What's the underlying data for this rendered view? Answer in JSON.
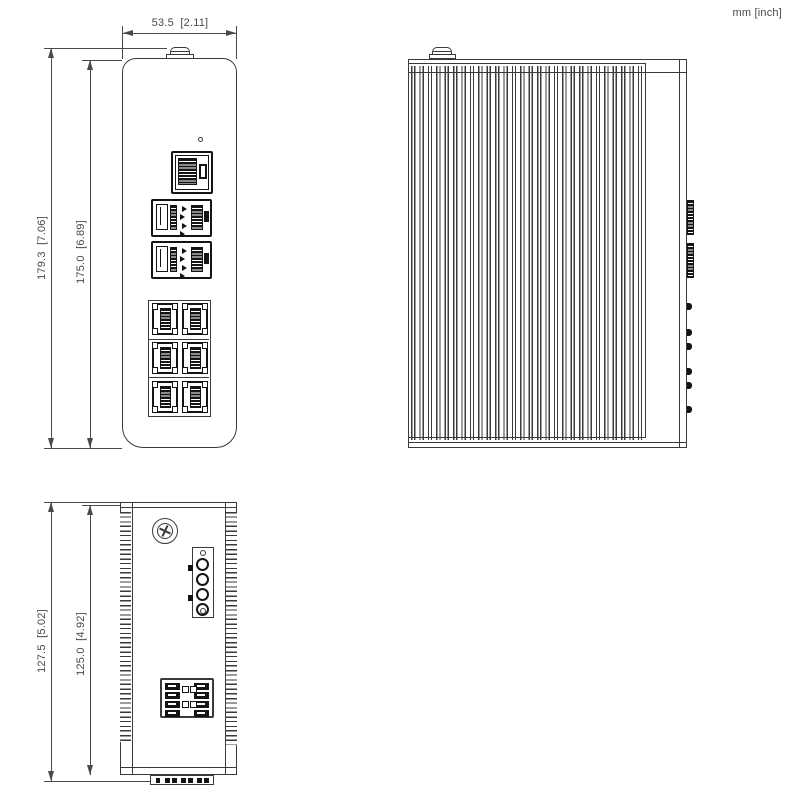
{
  "units_label": "mm [inch]",
  "dimensions": {
    "front_width": "53.5  [2.11]",
    "front_height_total": "179.3  [7.06]",
    "front_height_body": "175.0  [6.89]",
    "top_depth_total": "127.5  [5.02]",
    "top_depth_body": "125.0  [4.92]"
  },
  "colors": {
    "line": "#3a3a3a",
    "dim": "#4a4a4a",
    "port": "#141414",
    "bg": "#ffffff"
  }
}
